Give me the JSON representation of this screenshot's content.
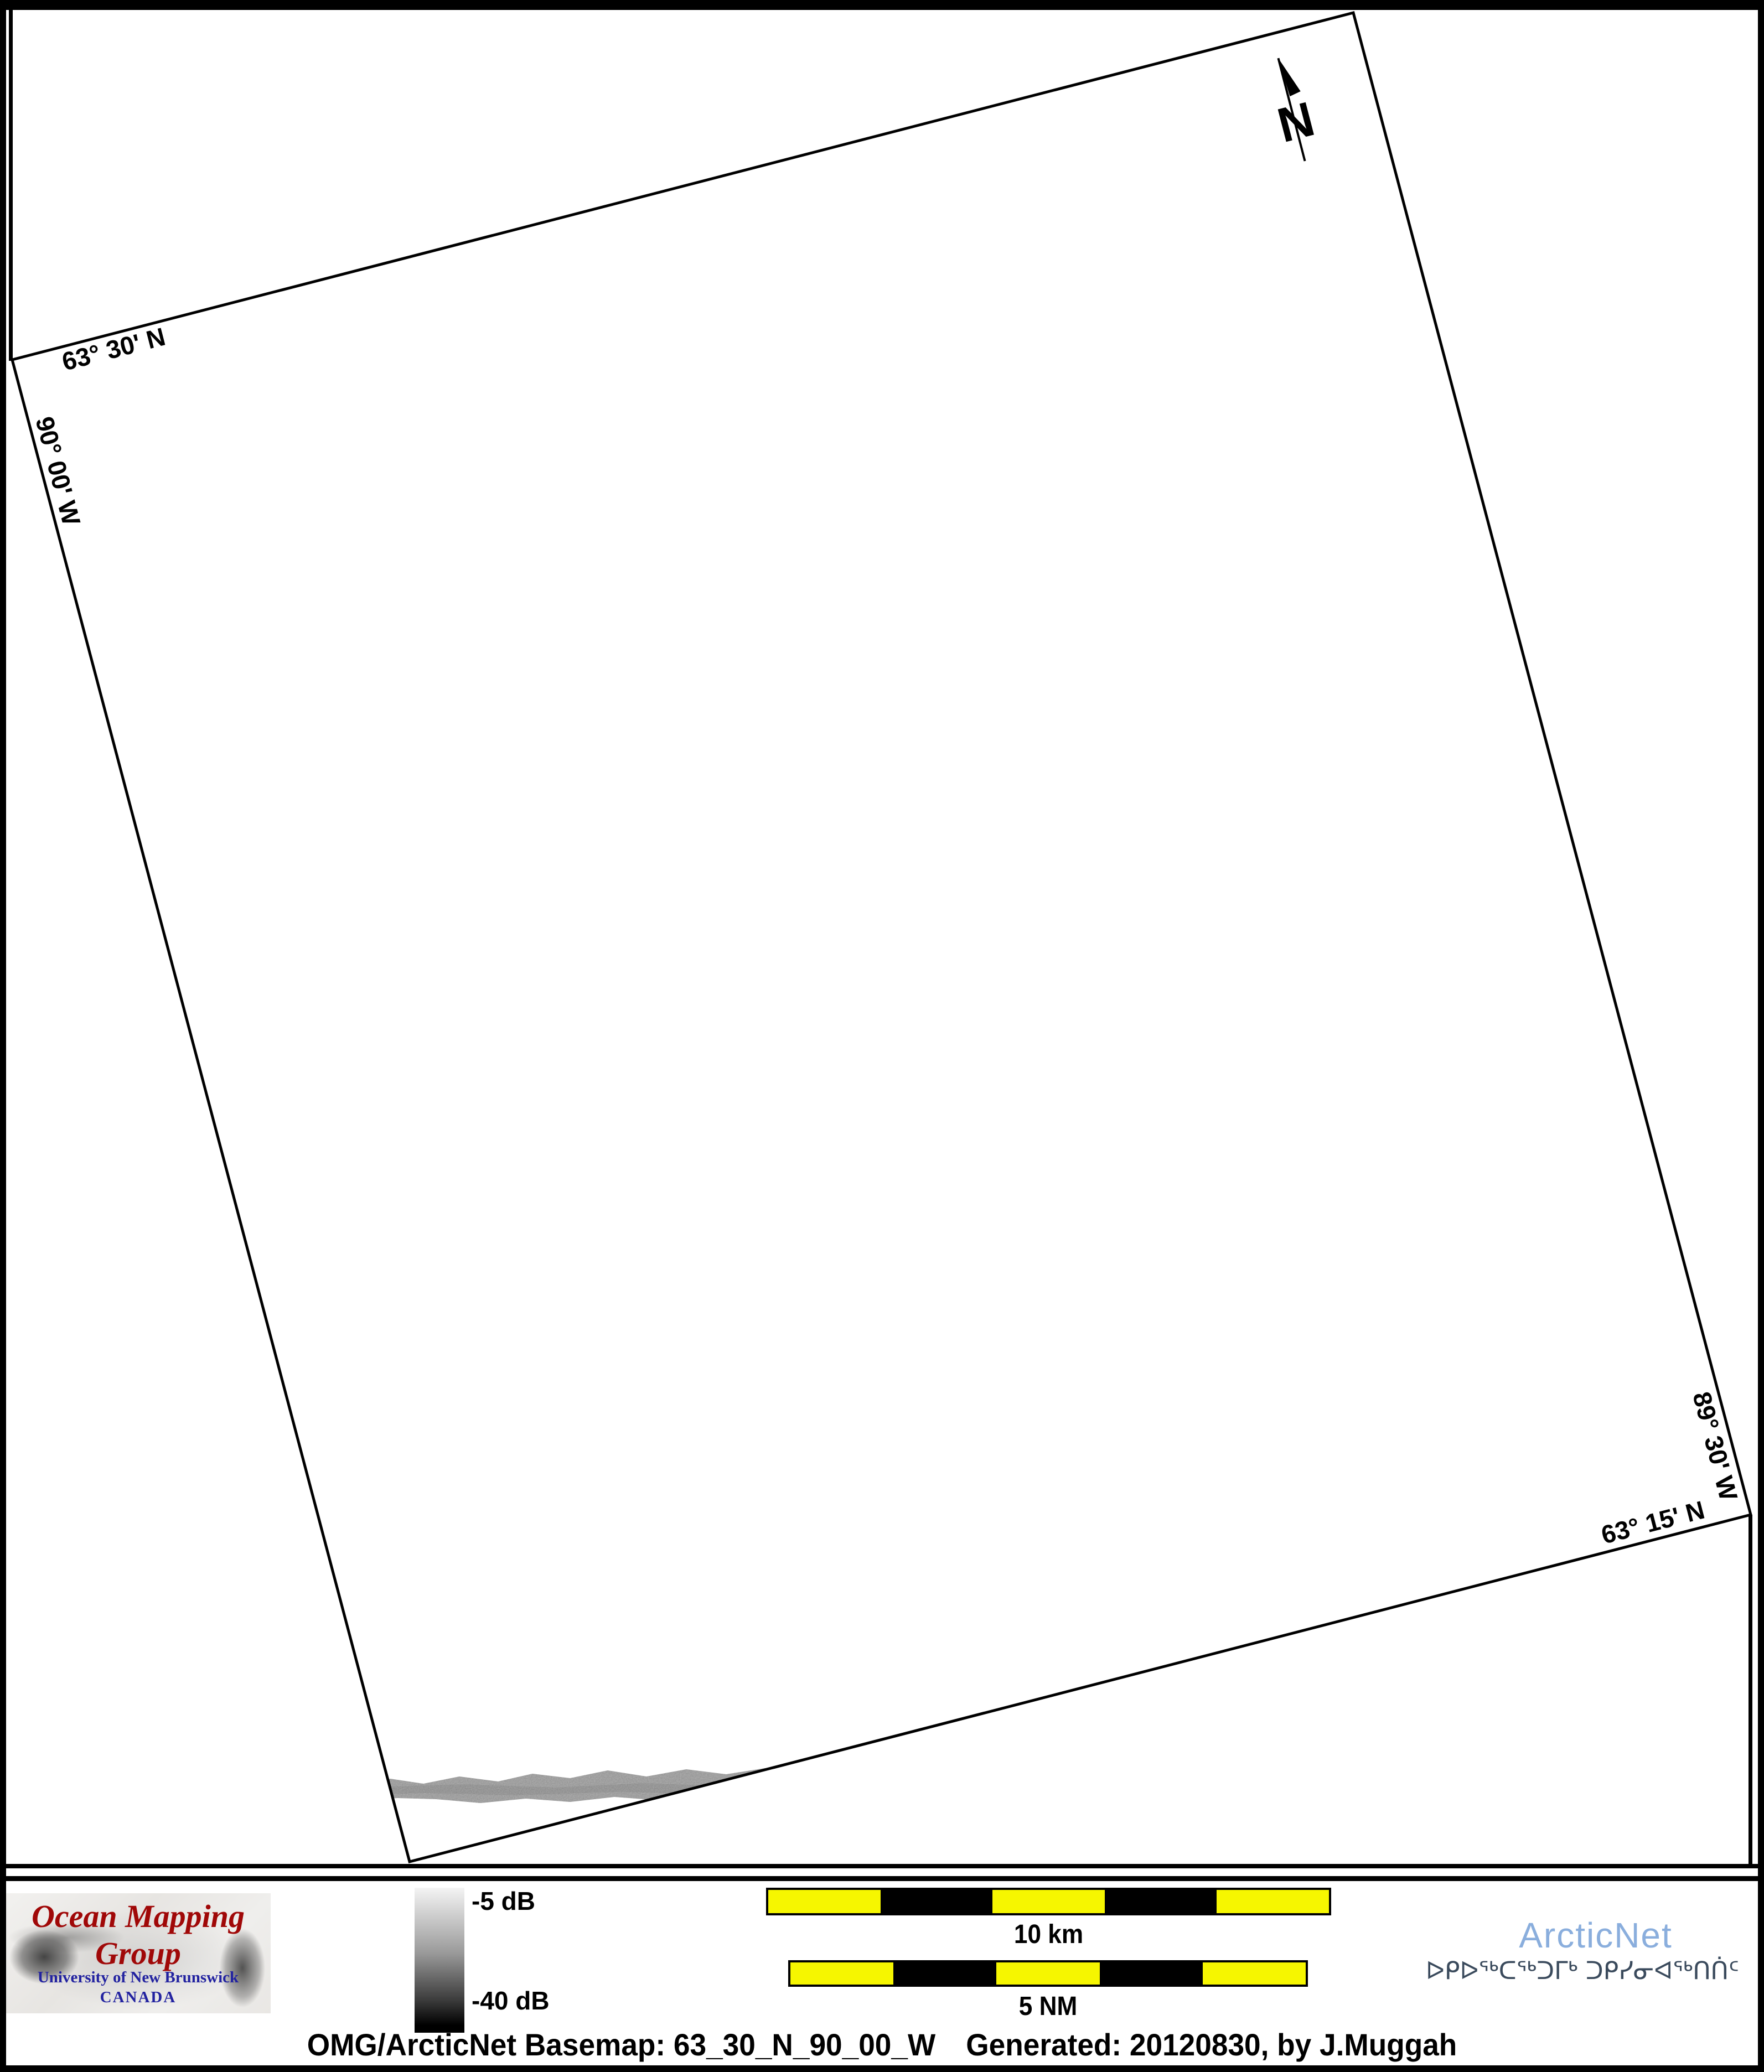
{
  "map": {
    "frame_labels": {
      "top_lat": "63° 30' N",
      "left_lon": "90° 00' W",
      "right_lon": "89° 30' W",
      "bottom_lat": "63° 15' N"
    },
    "north_label": "N"
  },
  "legend": {
    "top_value": "-5 dB",
    "bottom_value": "-40 dB"
  },
  "scale_bars": {
    "km_label": "10 km",
    "nm_label": "5 NM"
  },
  "logos": {
    "omg": {
      "title": "Ocean Mapping Group",
      "institution": "University of New Brunswick",
      "country": "CANADA"
    },
    "arcticnet": {
      "name": "ArcticNet",
      "inuktitut": "ᐅᑭᐅᖅᑕᖅᑐᒥᒃ ᑐᑭᓯᓂᐊᖅᑎᑏᑦ"
    }
  },
  "caption": {
    "left": "OMG/ArcticNet Basemap: 63_30_N_90_00_W",
    "right": "Generated: 20120830, by J.Muggah"
  },
  "colors": {
    "scale_yellow": "#f6f600",
    "omg_red": "#a00808",
    "unb_blue": "#2222a0",
    "arcticnet_blue": "#8aaedd",
    "inuktitut_navy": "#3a4a5c"
  }
}
